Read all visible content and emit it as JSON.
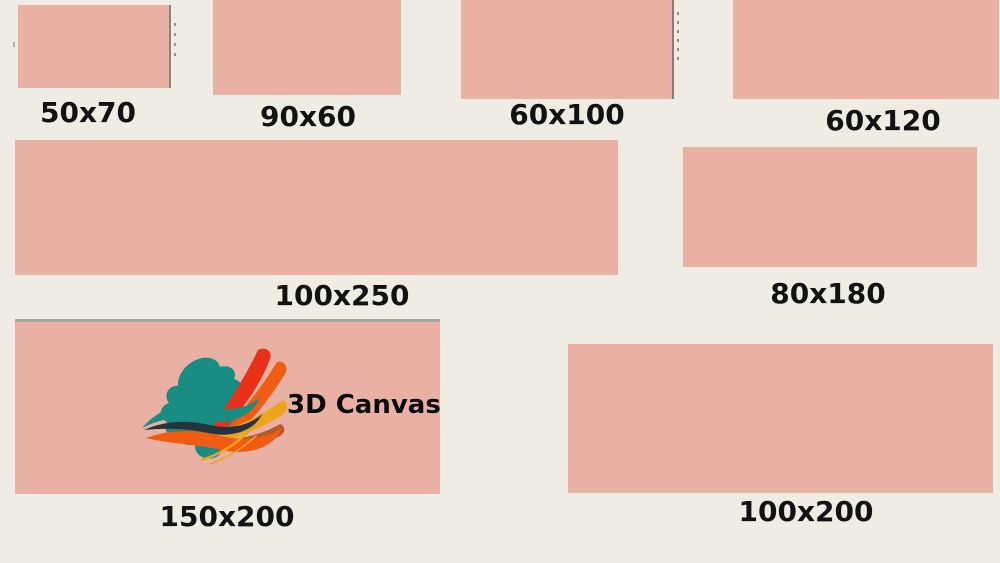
{
  "title": "Canvas size comparison",
  "colors": {
    "bg": "#efece3",
    "canvas": "#e9b0a4",
    "label": "#121212",
    "edge-gray": "#8b8680",
    "edge-dark": "#6f6a64",
    "logo-teal": "#1a8d82",
    "logo-dark": "#24343f",
    "logo-red": "#e8311a",
    "logo-orange": "#f05c12",
    "logo-amber": "#eda41c",
    "logo-brown": "#b75b28"
  },
  "items": [
    {
      "label": "50x70"
    },
    {
      "label": "90x60"
    },
    {
      "label": "60x100"
    },
    {
      "label": "60x120"
    },
    {
      "label": "100x250"
    },
    {
      "label": "80x180"
    },
    {
      "label": "150x200"
    },
    {
      "label": "100x200"
    }
  ],
  "logo": {
    "text": "3D Canvas"
  }
}
